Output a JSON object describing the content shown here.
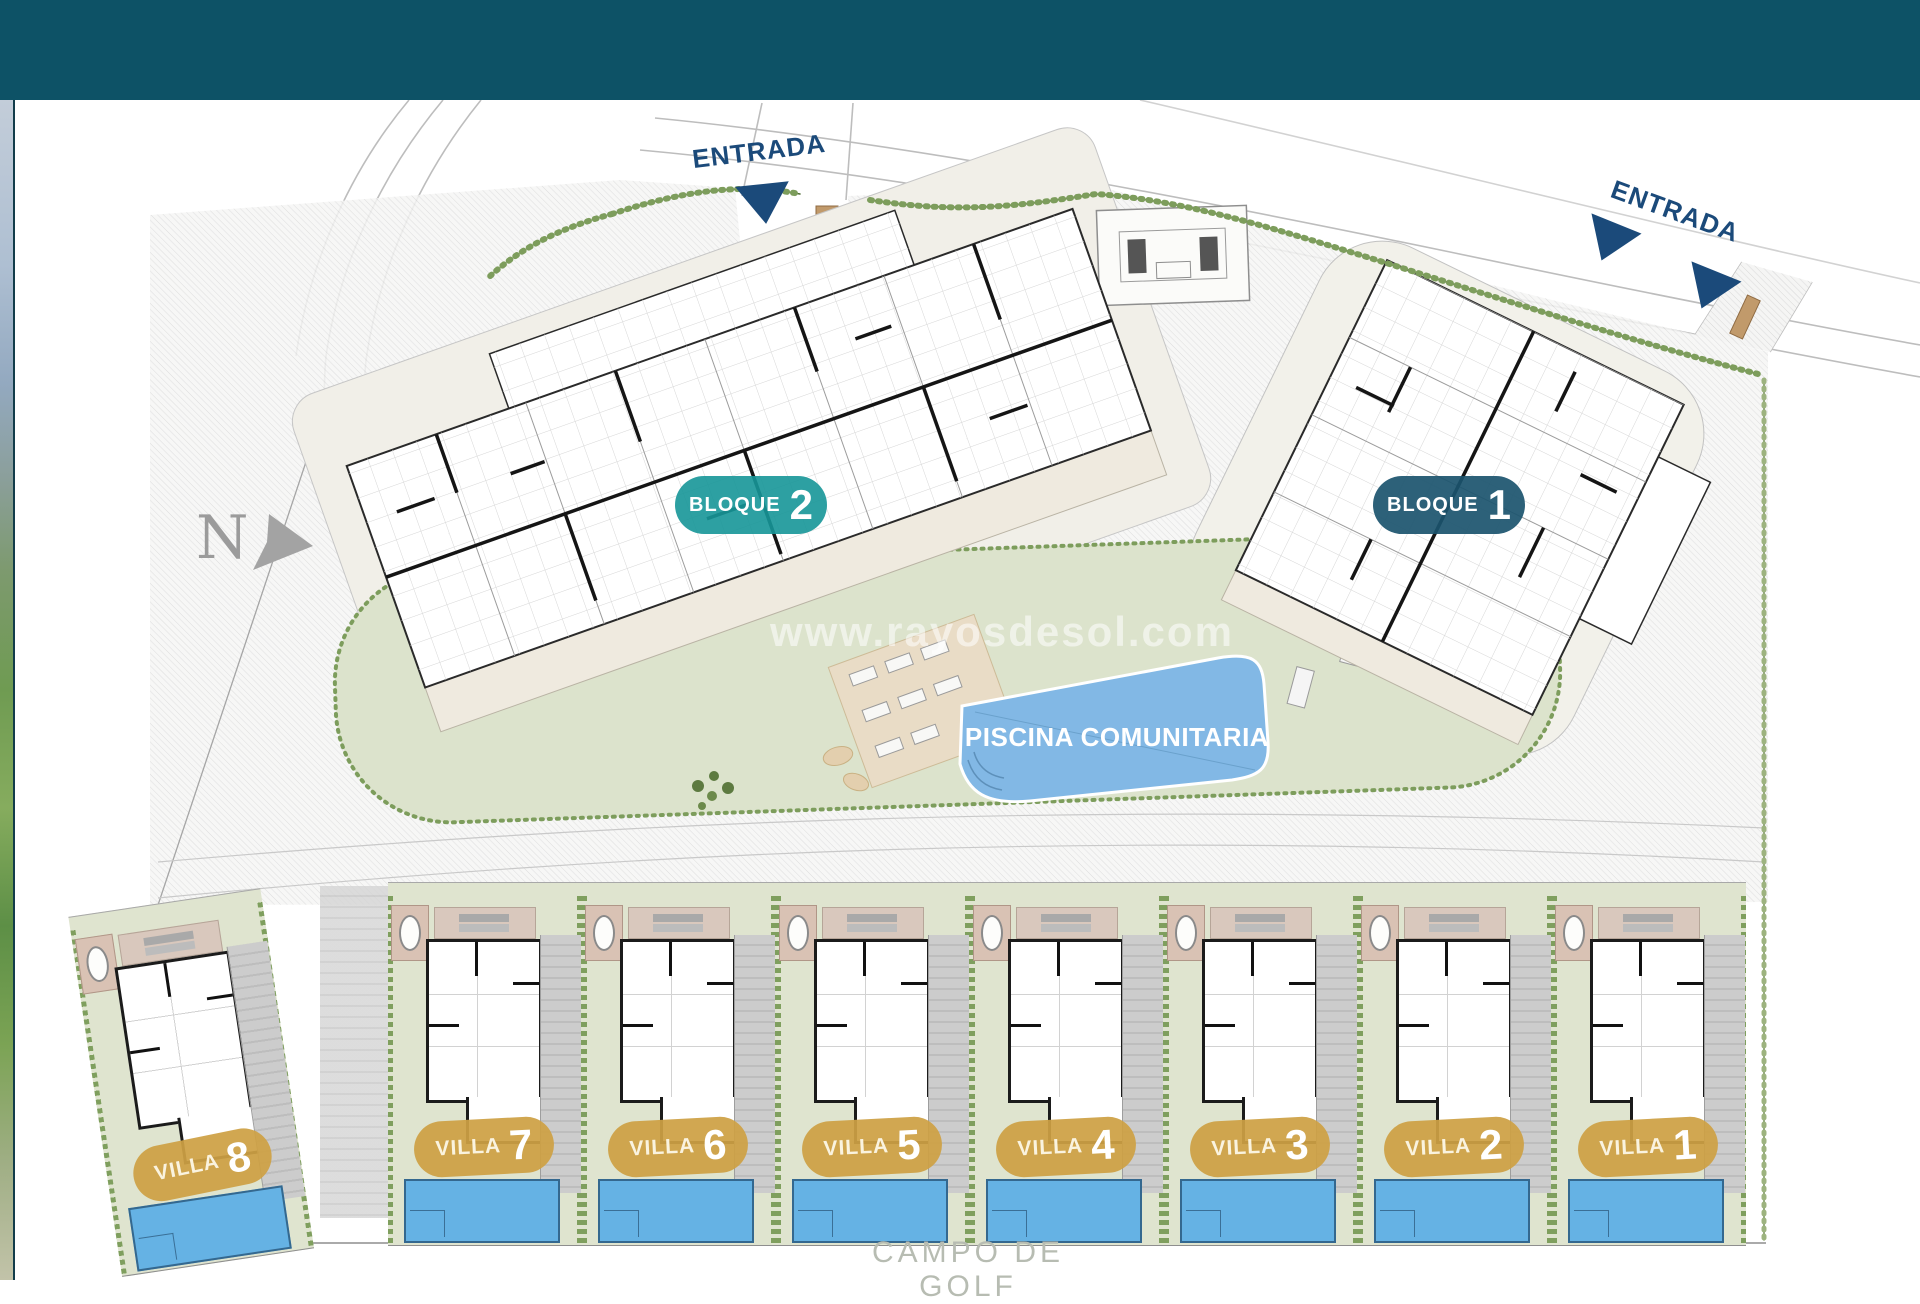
{
  "site_plan": {
    "entrance_top_label": "ENTRADA",
    "entrance_right_label": "ENTRADA",
    "north_label": "N",
    "pool_label": "PISCINA COMUNITARIA",
    "golf_label": "CAMPO DE GOLF",
    "watermark": "www.rayosdesol.com",
    "blocks": [
      {
        "label": "BLOQUE",
        "number": "2",
        "badge_color": "#169698"
      },
      {
        "label": "BLOQUE",
        "number": "1",
        "badge_color": "#1b546e"
      }
    ],
    "villas": [
      {
        "label": "VILLA",
        "number": "8"
      },
      {
        "label": "VILLA",
        "number": "7"
      },
      {
        "label": "VILLA",
        "number": "6"
      },
      {
        "label": "VILLA",
        "number": "5"
      },
      {
        "label": "VILLA",
        "number": "4"
      },
      {
        "label": "VILLA",
        "number": "3"
      },
      {
        "label": "VILLA",
        "number": "2"
      },
      {
        "label": "VILLA",
        "number": "1"
      }
    ],
    "colors": {
      "header_bar": "#0d5266",
      "villa_badge_gold": "#cda044",
      "pool_blue": "#7db9e8",
      "hedge_green": "#7d9d5c",
      "lawn_green": "#dde3cd",
      "entrance_navy": "#1b4a7a",
      "plan_line_gray": "#b5b5b5"
    }
  }
}
